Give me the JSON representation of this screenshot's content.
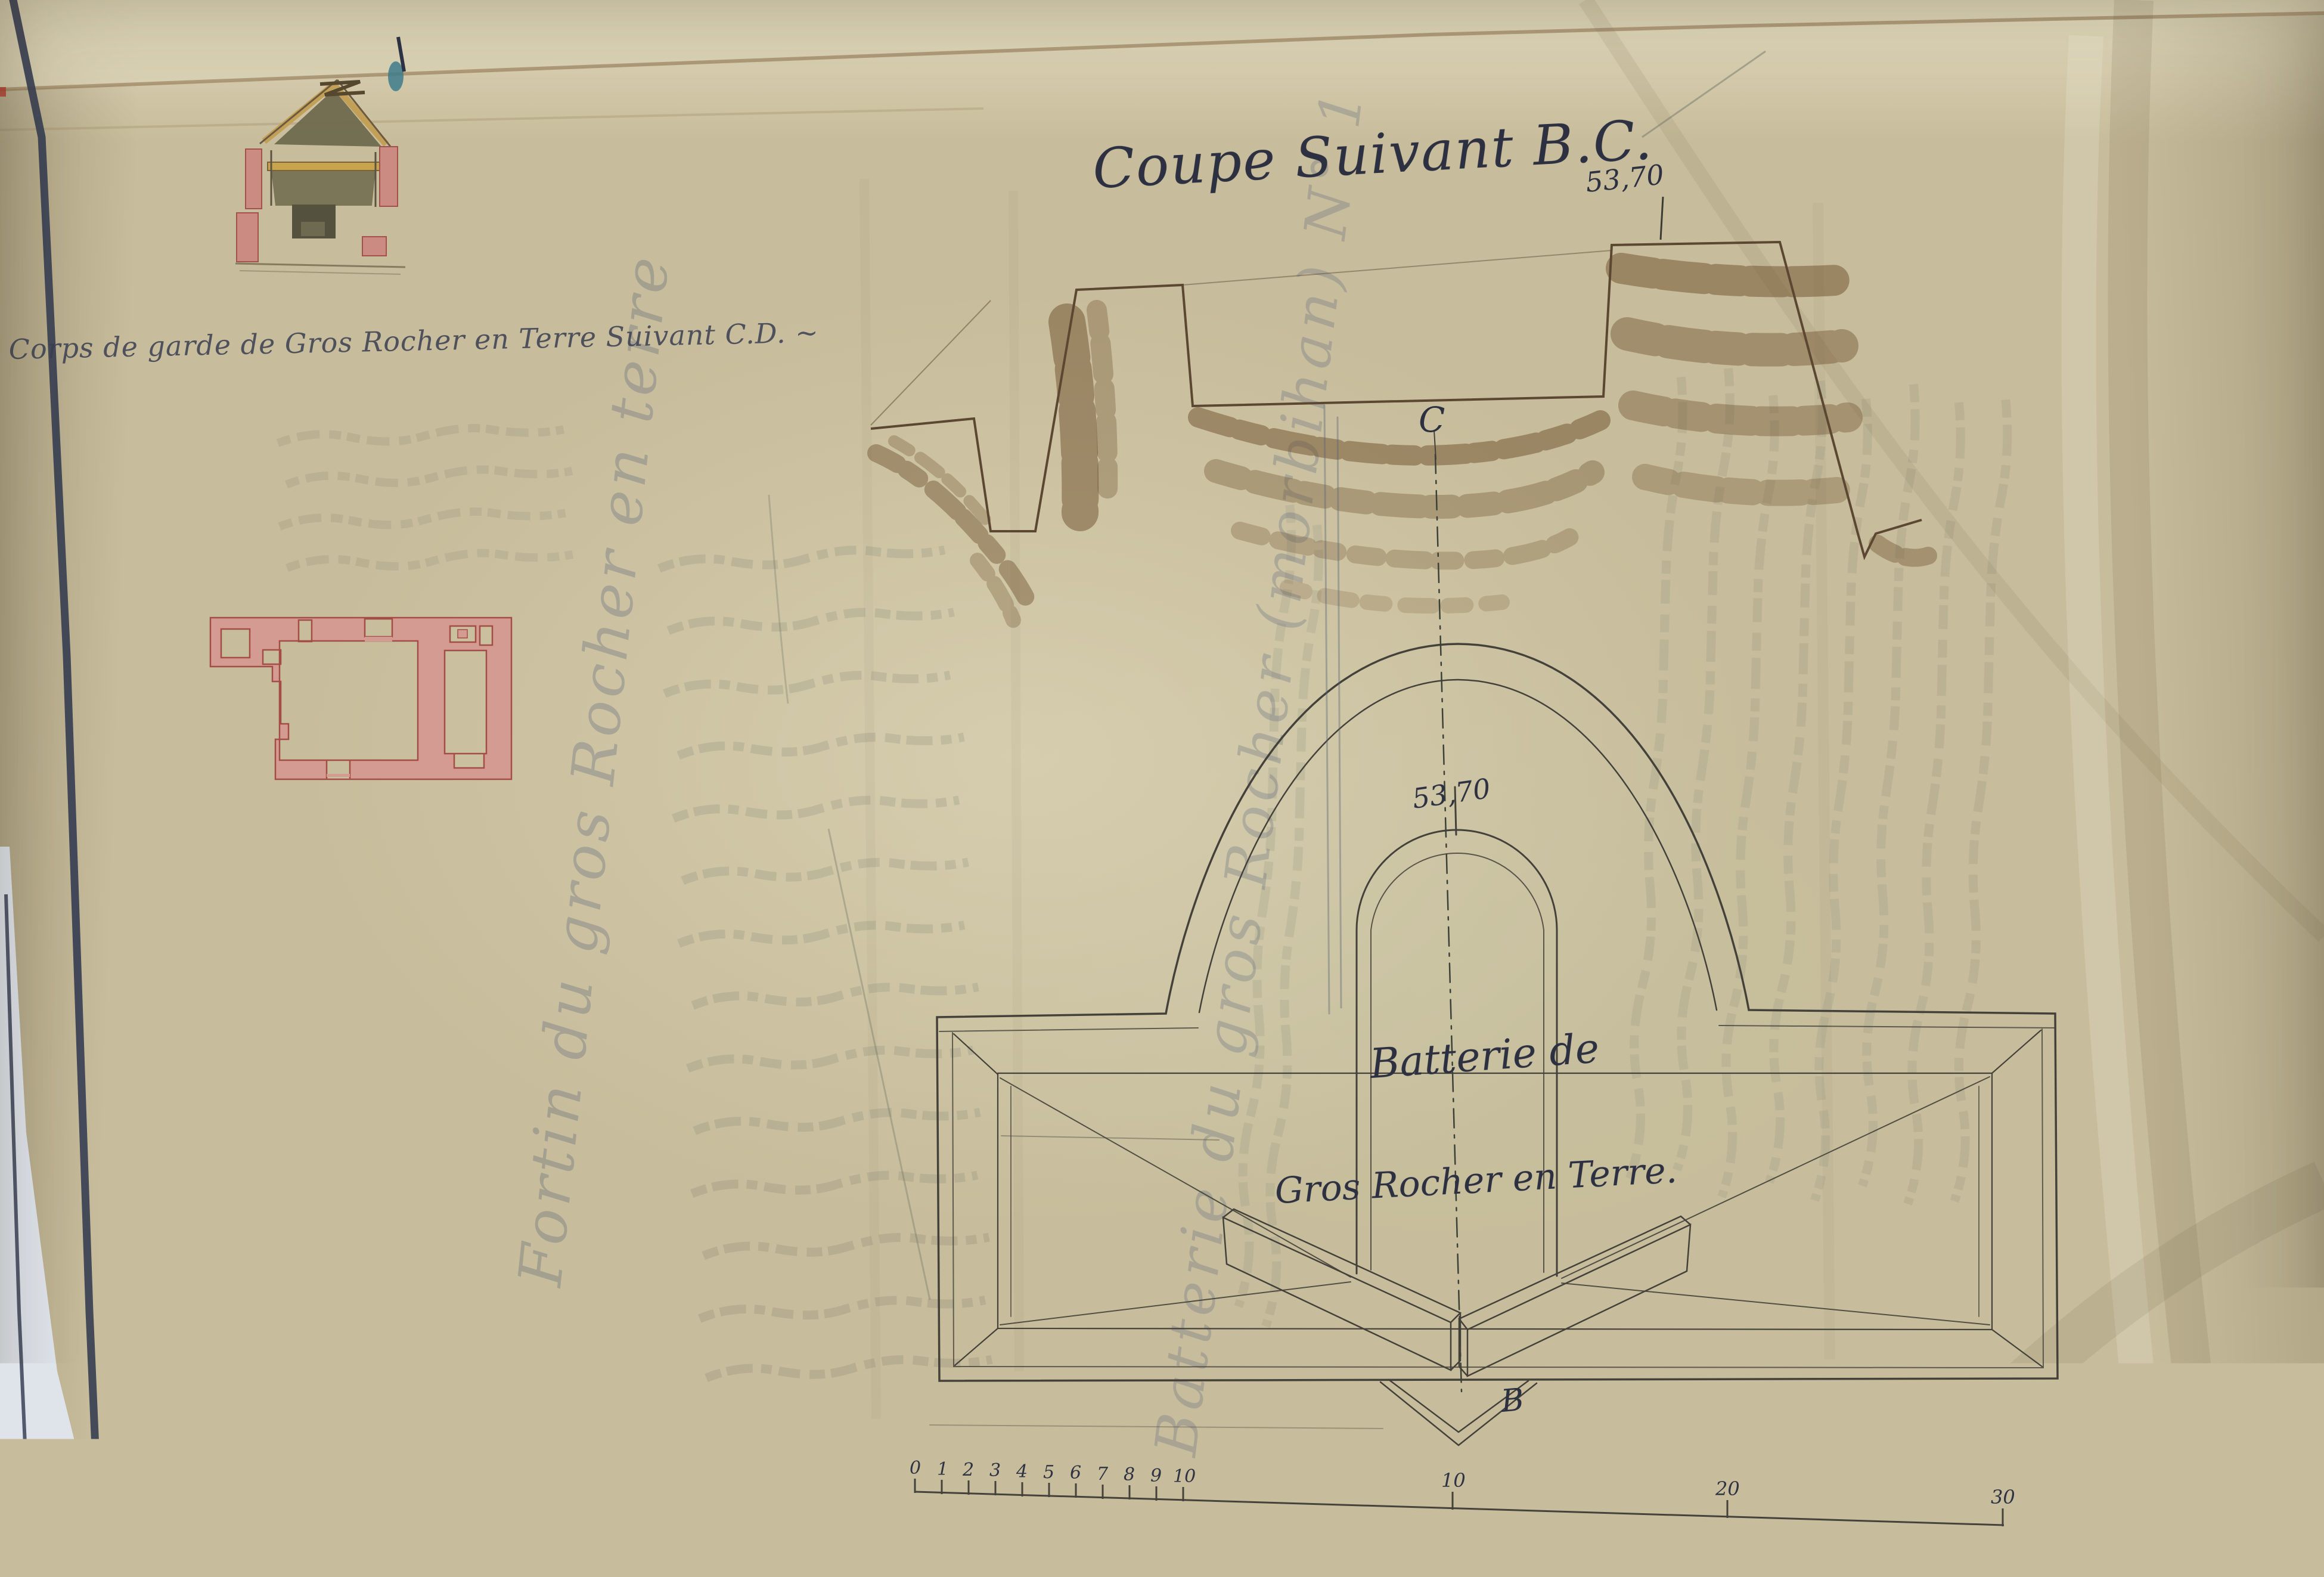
{
  "titles": {
    "coupe_title": "Coupe Suivant B.C.",
    "guardhouse_caption": "Corps de garde de Gros Rocher en Terre Suivant C.D. ~",
    "battery_line1": "Batterie de",
    "battery_line2": "Gros Rocher en Terre.",
    "scale_caption": "Echelle de cinq Millimètres pour Mètre."
  },
  "labels": {
    "elevation_section": "53,70",
    "elevation_plan": "53,70",
    "axis_point_top": "C",
    "axis_point_bottom": "B"
  },
  "ghost_writing": {
    "vertical_title": "Fortin du gros Rocher en terre",
    "diagonal_title": "Batterie du gros Rocher (morbihan) N° 1",
    "note": "illegible faint pencil handwriting in several blocks"
  },
  "margin_notes": {
    "upper": "H",
    "lower": "5746"
  },
  "scale_bar": {
    "minor_labels": [
      "0",
      "1",
      "2",
      "3",
      "4",
      "5",
      "6",
      "7",
      "8",
      "9",
      "10"
    ],
    "major_labels": [
      "10",
      "20",
      "30"
    ]
  },
  "colors": {
    "paper": "#c7bc9b",
    "ink": "#2c3040",
    "navy_border": "#3a4054",
    "pink_wall": "#d49b92",
    "pink_outline": "#a34d46",
    "earth_brown": "#6d4f2c",
    "roof_ochre": "#c2a057",
    "olive_interior": "#6f6a4e",
    "backing_paper": "#dfe4eb",
    "ghost_blue": "#57617a",
    "pencil_grey": "#6b7065"
  }
}
